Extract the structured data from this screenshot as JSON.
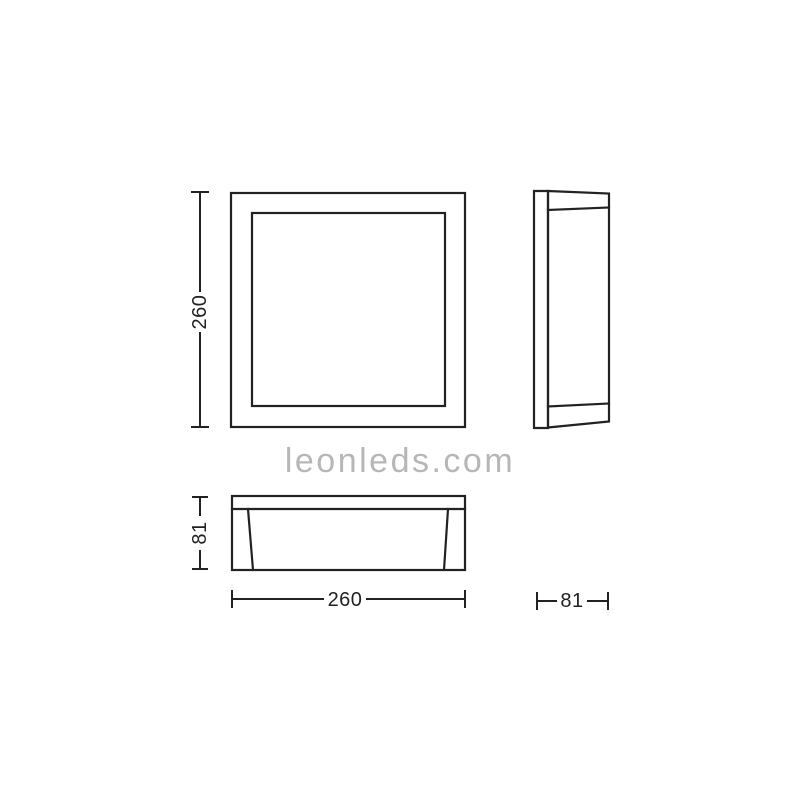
{
  "canvas": {
    "background": "#ffffff",
    "line_color": "#222222"
  },
  "dimensions": {
    "front_height": {
      "label": "260"
    },
    "bottom_depth": {
      "label": "81"
    },
    "bottom_width": {
      "label": "260"
    },
    "side_depth": {
      "label": "81"
    }
  },
  "watermark": {
    "text": "leonleds.com",
    "color": "#b7b7b7"
  }
}
